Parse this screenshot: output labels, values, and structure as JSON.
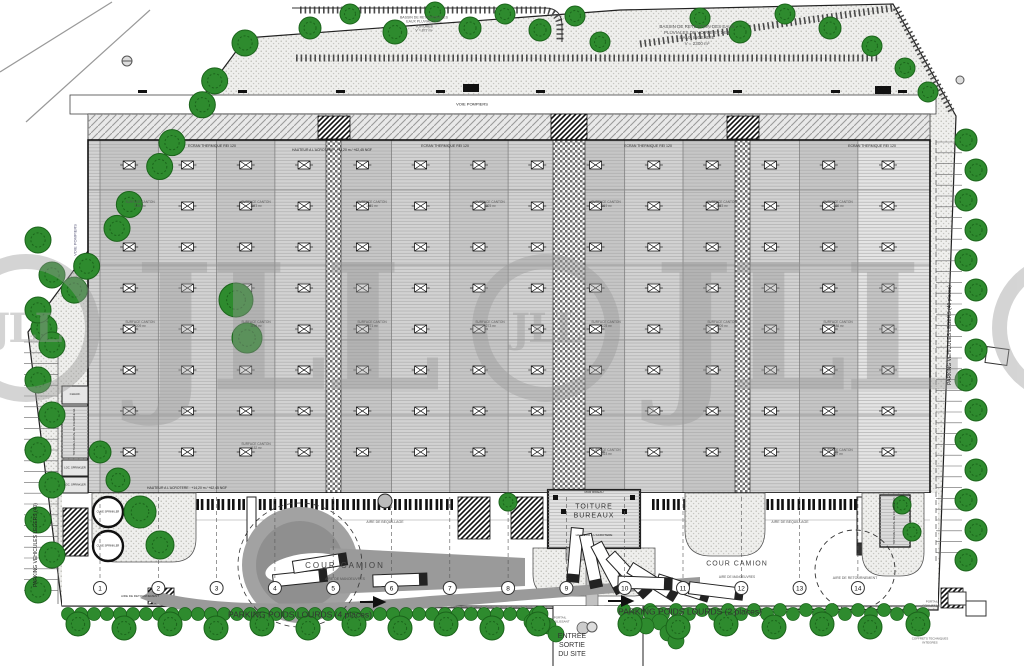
{
  "watermark": {
    "logo": "JLL"
  },
  "site": {
    "basin_toitures": {
      "l1": "BASSIN DE RETENTION DES",
      "l2": "EAUX PLUVIALES DE",
      "l3": "TOITURES",
      "l4": "V = 877 m³"
    },
    "basin_voirie": {
      "l1": "BASSIN DE RETENTION DES EAUX",
      "l2": "PLUVIALES DE VOIRIE ET DES",
      "l3": "EAUX INCENDIE",
      "l4": "V = 2300 m³"
    },
    "voie_pompiers": "VOIE POMPIERS",
    "cour_camion": "COUR CAMION",
    "aire_manoeuvres": "AIRE DE MANOEUVRES",
    "aire_bequillage": "AIRE DE BEQUILLAGE",
    "aire_retournement": "AIRE DE RETOURNEMENT",
    "parking_pl_4": "PARKING POIDS LOURDS (4 places)",
    "parking_pl_2": "PARKING POIDS LOURDS (2 places)",
    "parking_vl_left": "PARKING VEHICULES LEGERS (40)",
    "parking_vl_right": "PARKING VEHICULES LEGERS (40 places)",
    "entree": {
      "l1": "ENTREE",
      "l2": "SORTIE",
      "l3": "DU SITE"
    },
    "portail": {
      "l1": "PORTAIL",
      "l2": "COULISSANT"
    },
    "coffrets": {
      "l1": "COFFRETS TECHNIQUES",
      "l2": "INTEGRES"
    }
  },
  "building": {
    "ecran": "ECRAN THERMIQUE REI 120",
    "acrotere_top": "HAUTEUR A L'ACROTERE : +13,20 m / +62,45 NGF",
    "acrotere_bottom": "HAUTEUR A L'ACROTERE : +14,20 m / +62,45 NGF",
    "surface_canton": "SURFACE CANTON",
    "surface_canton_values": [
      "1286 m²",
      "1273 m²",
      "1271 m²",
      "1225 m²",
      "1219 m²",
      "1273 m²",
      "1225 m²",
      "1209 m²",
      "1196 m²",
      "1271 m²",
      "1273 m²",
      "1225 m²",
      "1209 m²",
      "1186 m²",
      "1152 m²",
      "1023 m²",
      "997 m²"
    ],
    "toiture_bureaux": {
      "l1": "TOITURE",
      "l2": "BUREAUX"
    },
    "mur_rideau": "MUR RIDEAU",
    "acrotere_bureaux": "HAUTEUR A L'ACROTERE",
    "chauf": "CHAUF.",
    "local_charge_g1": "TOITURE LOCAL DE CHARGE G1",
    "local_charge_g4": "TOITURE LOCAL DE CHARGE G4",
    "loc_sprinkler": "LOC. SPRINKLER",
    "cuve_sprinkler": "CUVE SPRINKLER"
  },
  "axes": {
    "numbers": [
      "1",
      "2",
      "3",
      "4",
      "5",
      "6",
      "7",
      "8",
      "9",
      "10",
      "11",
      "12",
      "13",
      "14"
    ]
  }
}
